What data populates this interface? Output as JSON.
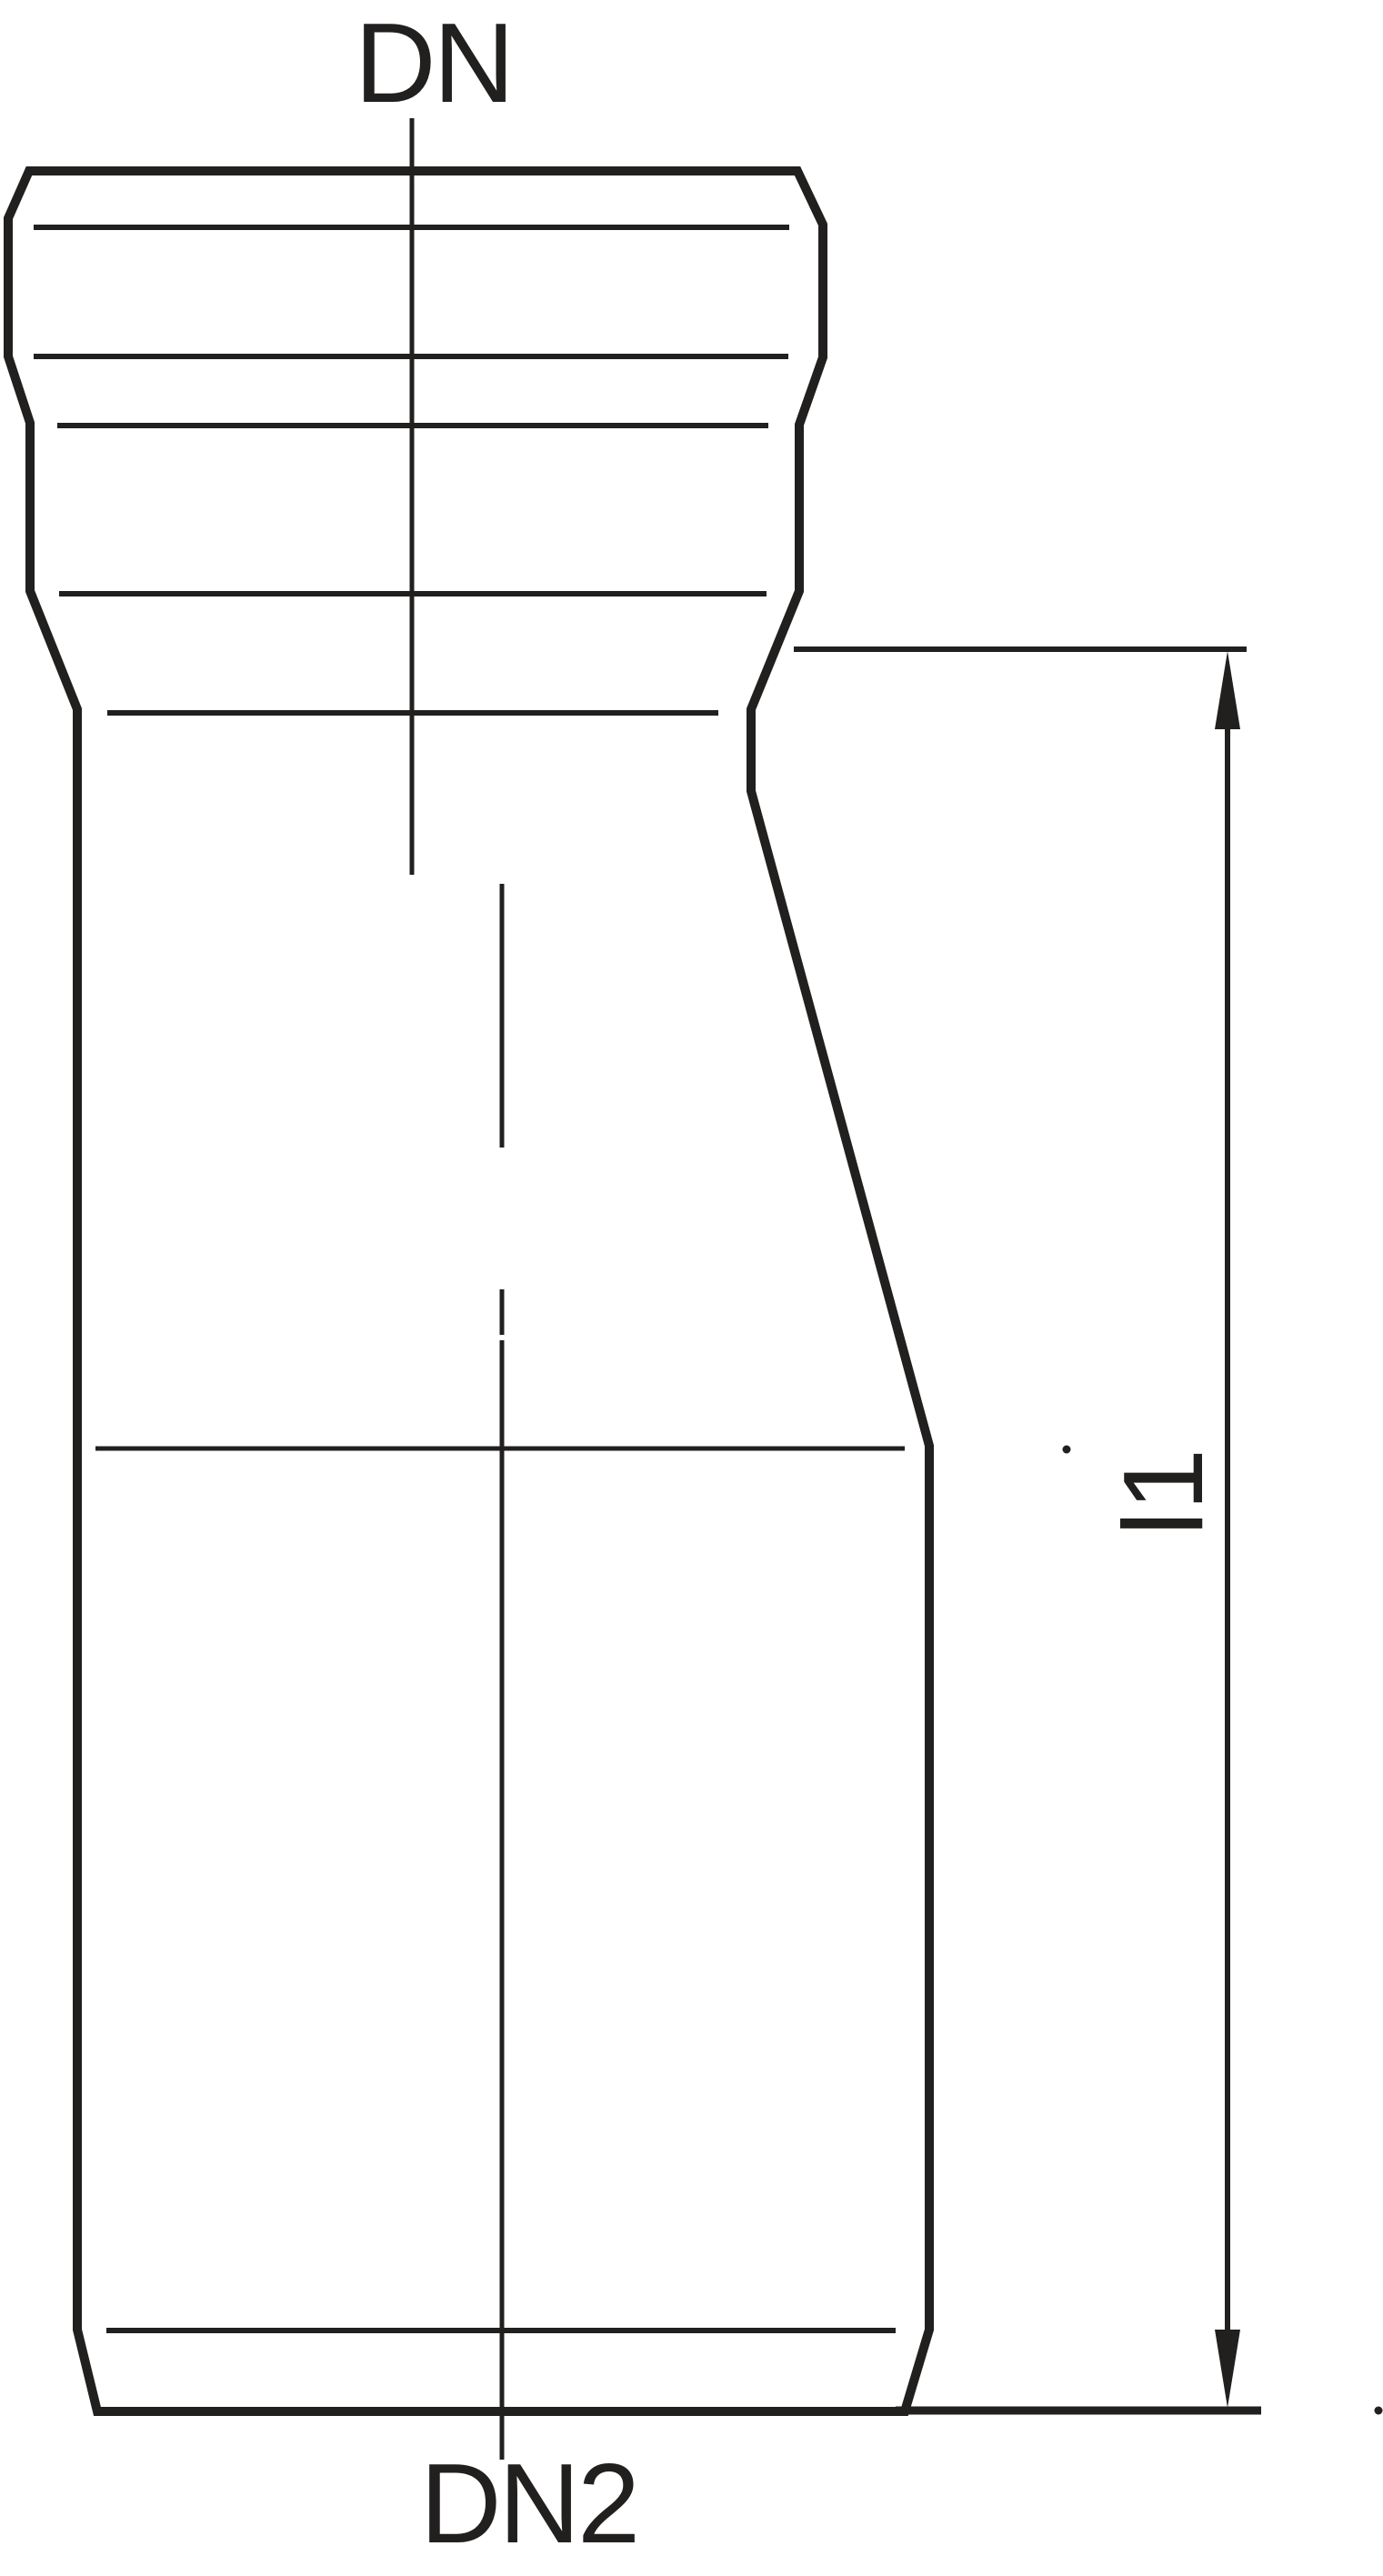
{
  "diagram": {
    "type": "technical-drawing",
    "subject": "pipe-reducer-fitting",
    "labels": {
      "dn_top": "DN",
      "dn2_bottom": "DN2",
      "length_dim": "l1"
    },
    "colors": {
      "line": "#221f1f",
      "background": "#ffffff"
    }
  }
}
